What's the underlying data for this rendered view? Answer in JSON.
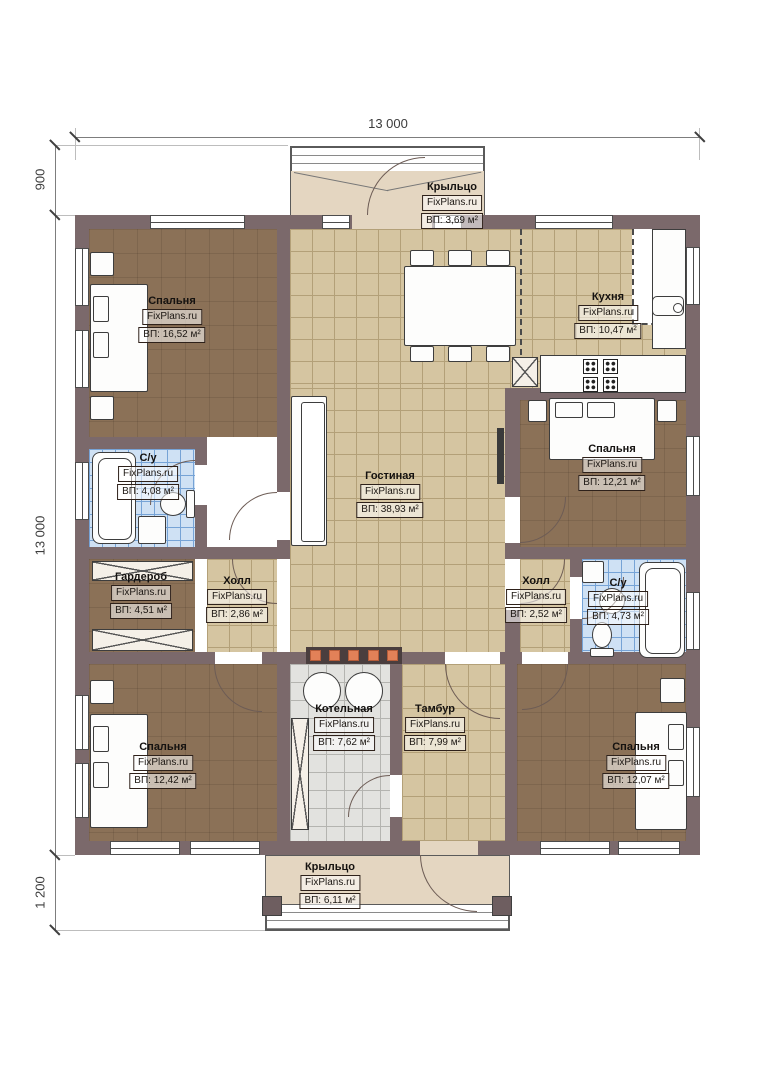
{
  "plan": {
    "watermark": "FixPlans.ru",
    "dimensions": {
      "width_top": "13 000",
      "porch_top_depth": "900",
      "height_left": "13 000",
      "porch_bottom_depth": "1 200"
    },
    "rooms": [
      {
        "id": "porch-top",
        "name": "Крыльцо",
        "area": "ВП: 3,69 м²"
      },
      {
        "id": "bedroom-tl",
        "name": "Спальня",
        "area": "ВП: 16,52 м²"
      },
      {
        "id": "kitchen",
        "name": "Кухня",
        "area": "ВП: 10,47 м²"
      },
      {
        "id": "bath-left",
        "name": "С/у",
        "area": "ВП: 4,08 м²"
      },
      {
        "id": "living",
        "name": "Гостиная",
        "area": "ВП: 38,93 м²"
      },
      {
        "id": "bedroom-r",
        "name": "Спальня",
        "area": "ВП: 12,21 м²"
      },
      {
        "id": "wardrobe",
        "name": "Гардероб",
        "area": "ВП: 4,51 м²"
      },
      {
        "id": "hall-left",
        "name": "Холл",
        "area": "ВП: 2,86 м²"
      },
      {
        "id": "hall-right",
        "name": "Холл",
        "area": "ВП: 2,52 м²"
      },
      {
        "id": "bath-right",
        "name": "С/у",
        "area": "ВП: 4,73 м²"
      },
      {
        "id": "bedroom-bl",
        "name": "Спальня",
        "area": "ВП: 12,42 м²"
      },
      {
        "id": "boiler",
        "name": "Котельная",
        "area": "ВП: 7,62 м²"
      },
      {
        "id": "tambur",
        "name": "Тамбур",
        "area": "ВП: 7,99 м²"
      },
      {
        "id": "bedroom-br",
        "name": "Спальня",
        "area": "ВП: 12,07 м²"
      },
      {
        "id": "porch-bottom",
        "name": "Крыльцо",
        "area": "ВП: 6,11 м²"
      }
    ],
    "colors": {
      "wall": "#7b696b",
      "tile_tan": "#d5c5a1",
      "tile_blue": "#cfe1f4",
      "tile_gray": "#e2e2df",
      "floor_brown": "#8b7157",
      "porch": "#e4d6c1",
      "radiator_accent": "#e28158"
    }
  }
}
